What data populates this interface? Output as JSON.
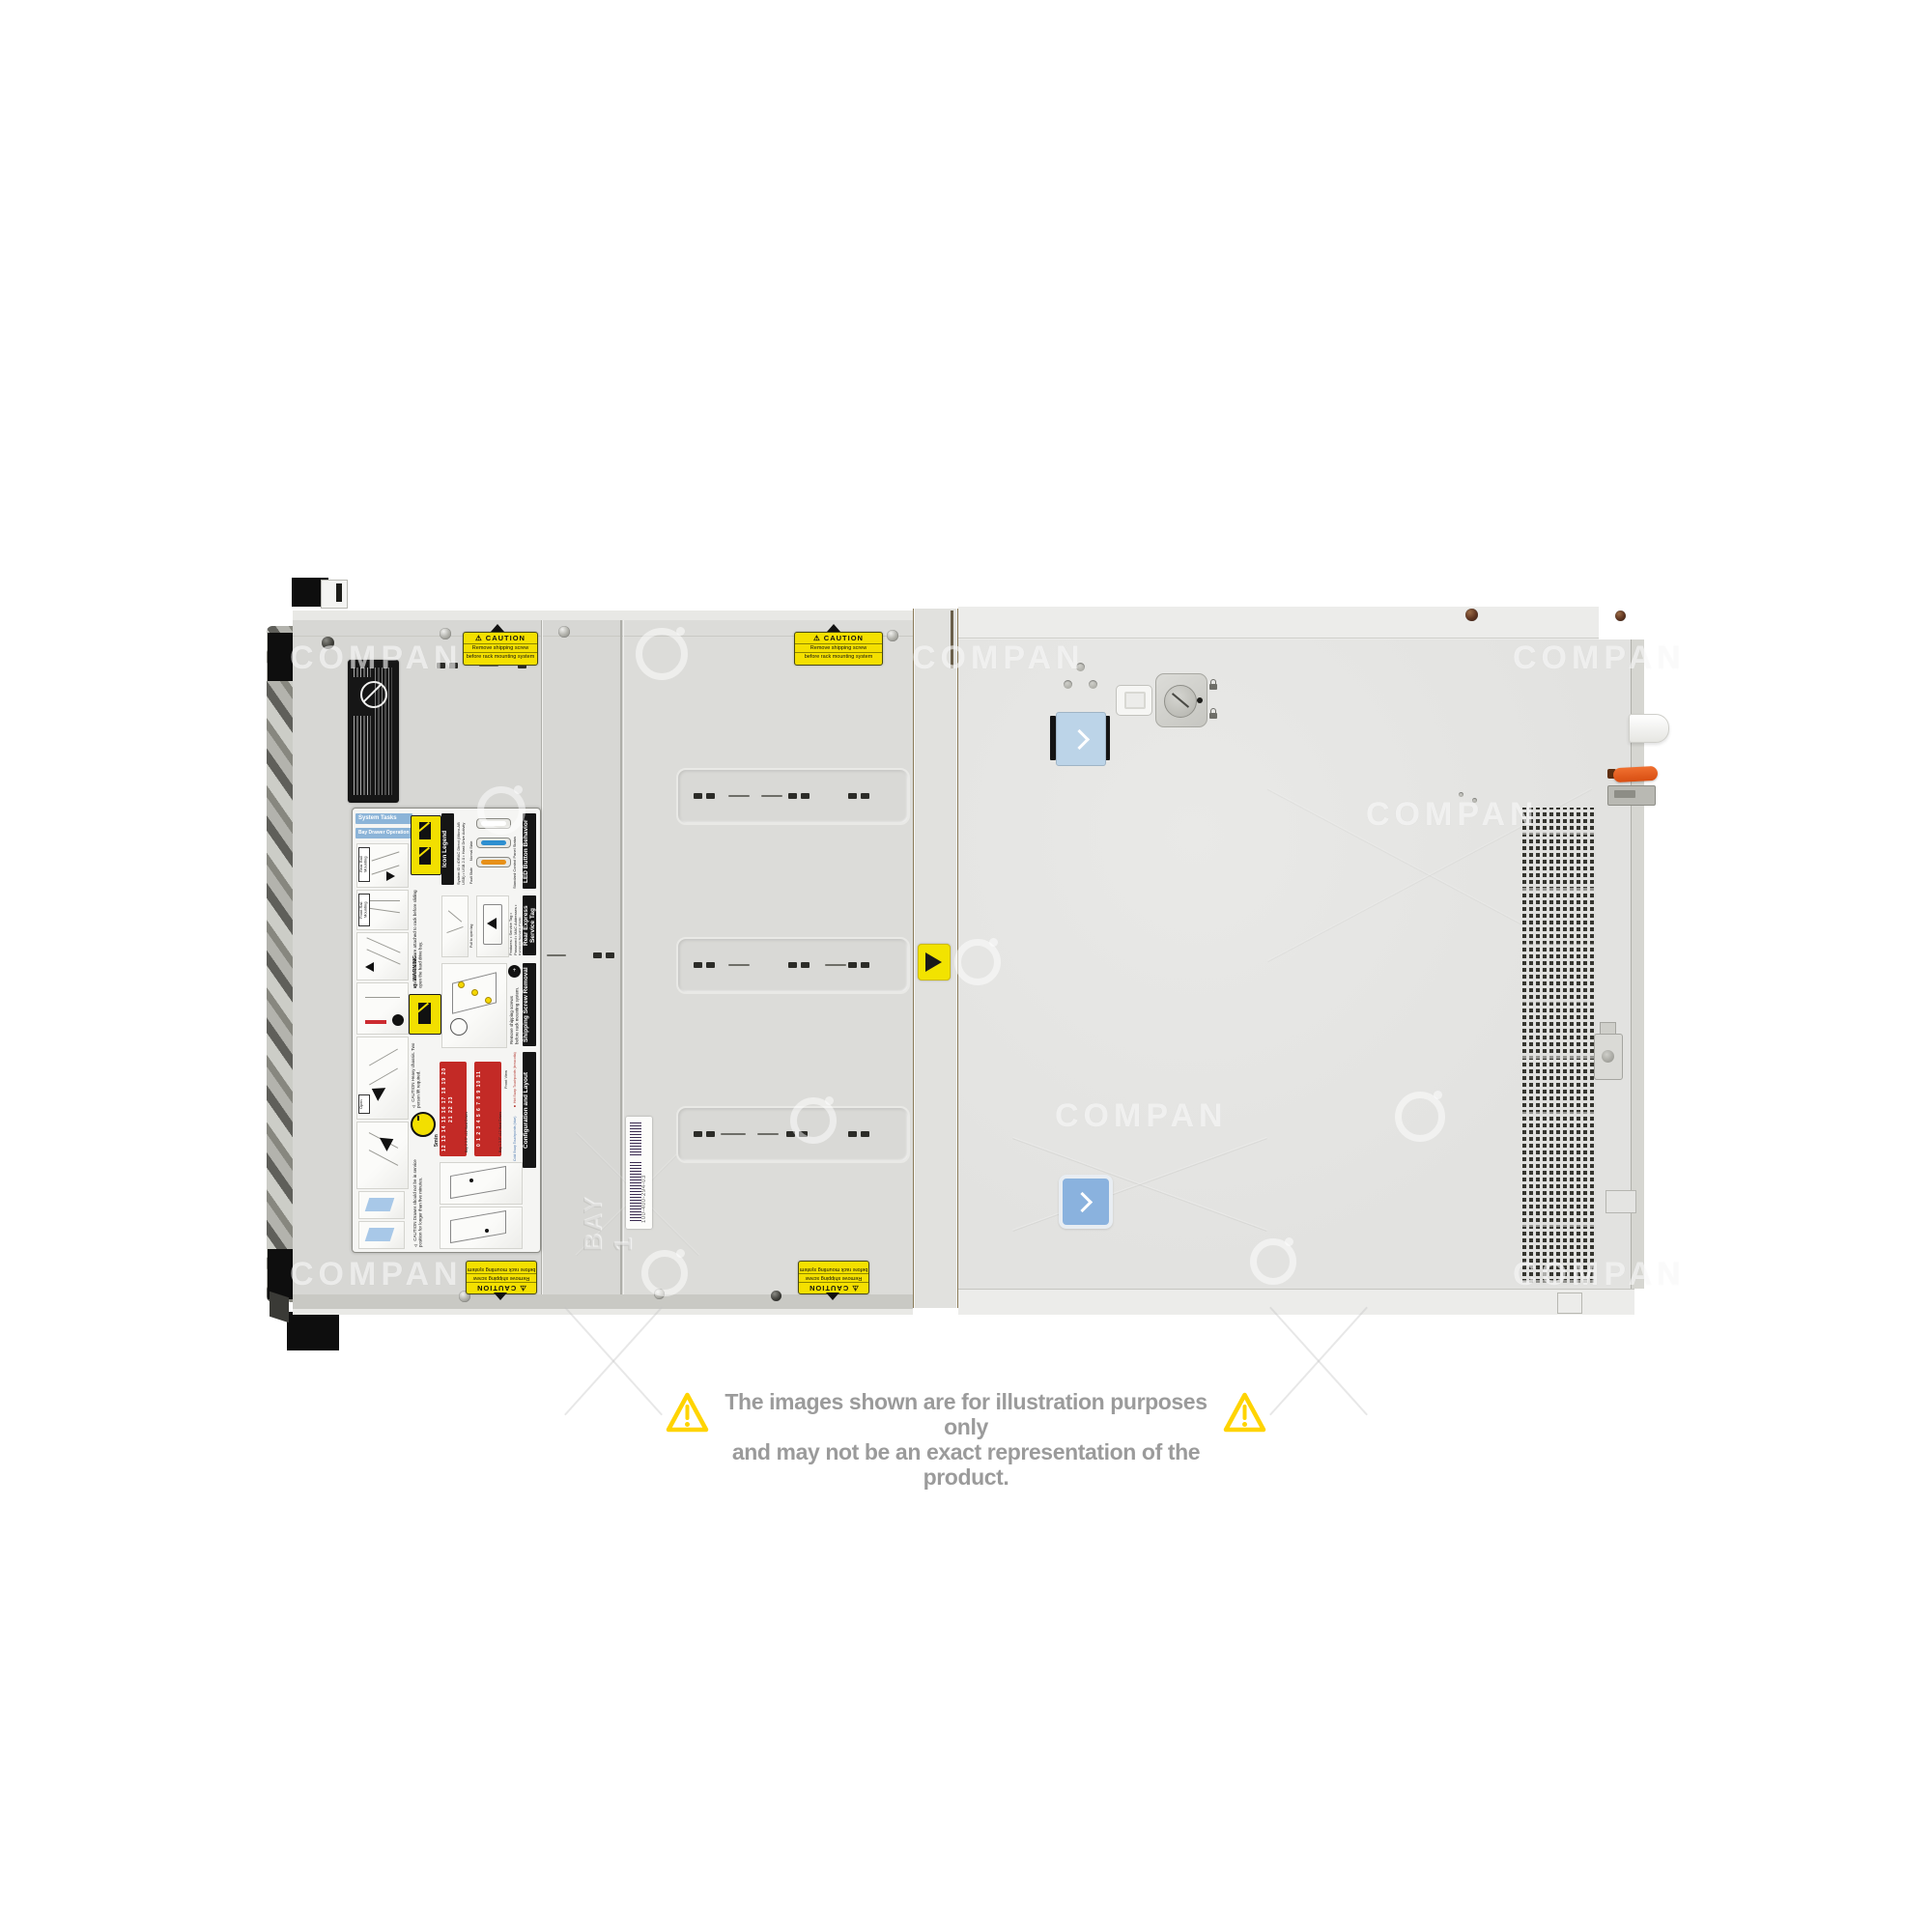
{
  "image": {
    "type": "watermarked-product-photo",
    "subject": "rack-server-top-view"
  },
  "watermark": {
    "text": "COMPAN"
  },
  "disclaimer": {
    "line1": "The images shown are for illustration purposes only",
    "line2": "and may not be an exact representation of the product.",
    "text_color": "#9b9b9b",
    "triangle_color": "#FFD400"
  },
  "labels": {
    "caution": {
      "title": "⚠ CAUTION",
      "line1": "Remove shipping screw",
      "line2": "before rack mounting system"
    },
    "barcode": {
      "part_number": "100-400-294-03"
    },
    "embossed_bay": "BAY 1"
  },
  "service_label": {
    "system_tasks": "System Tasks",
    "bay_drawer_operation": "Bay Drawer Operation",
    "rear_rail": "Rear Rail Mounting",
    "front_rail": "Front Rail Mounting",
    "open_tag": "Open",
    "warning_title": "⚠ WARNING",
    "warning_body": "Ensure that rails are attached to rack before sliding open the hard drive bay.",
    "icon_legend_title": "Icon Legend",
    "icon_legend_items": "System ID • iDRAC Direct (Micro-AB USB) • USB 2.0 • Hard Drive Activity",
    "led_title": "LED Button Behavior",
    "led_subtitle": "Standard Control Panel Status",
    "led_normal": "Normal State",
    "led_fault": "Fault State",
    "rest_title": "Rear Express Service Tag",
    "rest_features": "Features: • Service Tag • Password • MAC Addresses • Express Service Code",
    "rest_pull": "Pull to open tag",
    "ssr_title": "Shipping Screw Removal",
    "ssr_body": "Remove shipping screws before rack mounting system.",
    "caution_heavy": "⚠ CAUTION Heavy chassis. Two person lift required.",
    "five_min": "5min",
    "caution_drawer": "⚠ CAUTION Drawer should not be in service position for longer than five minutes.",
    "config_title": "Configuration and Layout",
    "front_view": "Front View",
    "hot_swap": "■ Hot Swap Touchpoints (terracotta)",
    "cold_swap": "■ Cold Swap Touchpoints (blue)",
    "bay1_label": "Bay 1  3.5\" x12 Hard Drives",
    "bay1_numbers": "0 1 2 3 4 5 6 7 8 9 10 11",
    "bay2_label": "Bay 2  3.5\" x12 Hard Drives",
    "bay2_numbers": "12 13 14 15 16 17 18 19 20 21 22 23"
  }
}
